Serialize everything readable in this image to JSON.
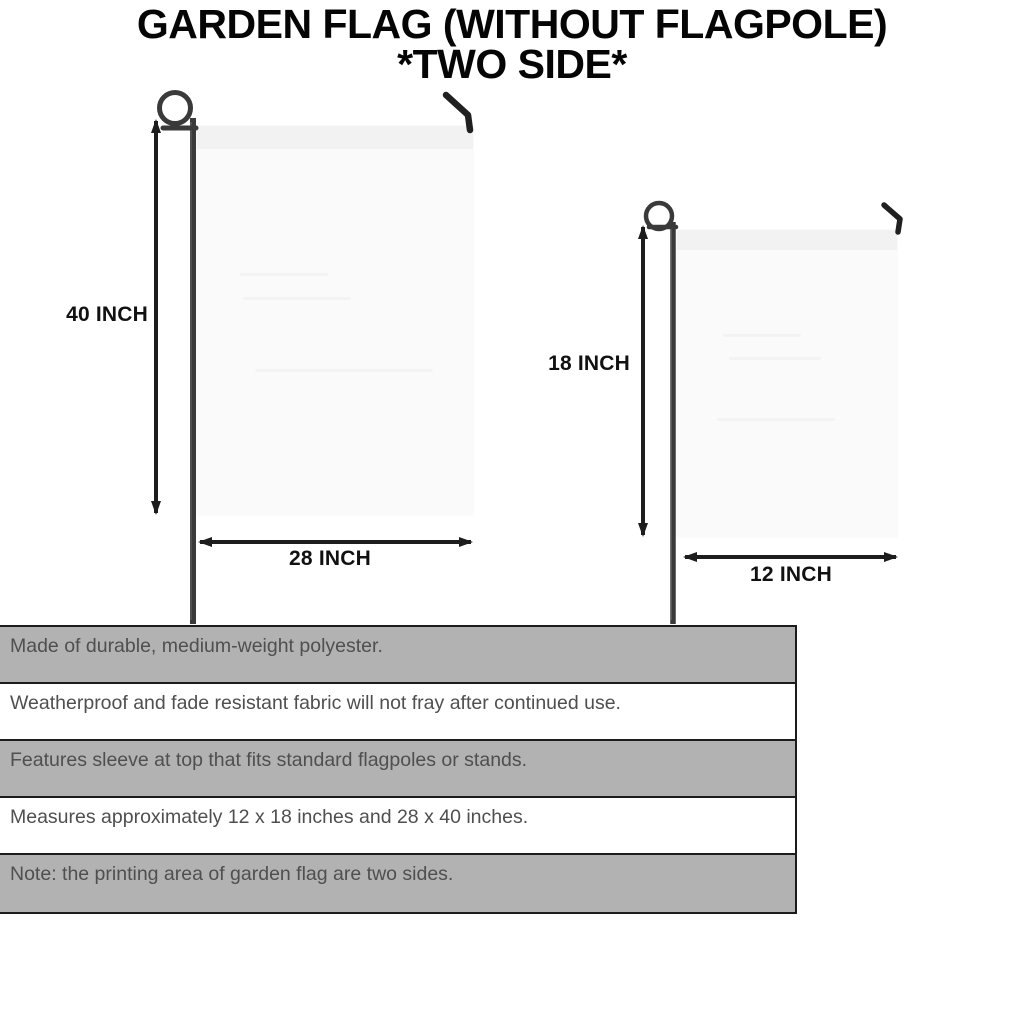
{
  "title": {
    "line1": "GARDEN FLAG (WITHOUT FLAGPOLE)",
    "line2": "*TWO SIDE*"
  },
  "flags": {
    "large": {
      "height_label": "40 INCH",
      "width_label": "28 INCH"
    },
    "small": {
      "height_label": "18 INCH",
      "width_label": "12 INCH"
    }
  },
  "specs": {
    "rows": [
      "Made of durable, medium-weight polyester.",
      "Weatherproof and fade resistant fabric will not fray after continued use.",
      "Features sleeve at top that fits standard flagpoles or stands.",
      "Measures approximately 12 x 18 inches and 28 x 40 inches.",
      "Note: the printing area of garden flag are two sides."
    ]
  },
  "icons": {
    "flagpole_loop": "pigtail-loop-icon",
    "flagpole_hook": "bent-hook-icon",
    "dimension_arrow": "double-headed-arrow-icon"
  },
  "colors": {
    "row_gray": "#b2b2b2",
    "row_white": "#ffffff",
    "border": "#1c1c1c",
    "flag_fill": "#fafafa",
    "flag_sleeve": "#f2f2f2",
    "pole": "#3a3a3a",
    "dimension_text": "#111111",
    "spec_text": "#4f4f4f",
    "title_text": "#050505"
  }
}
